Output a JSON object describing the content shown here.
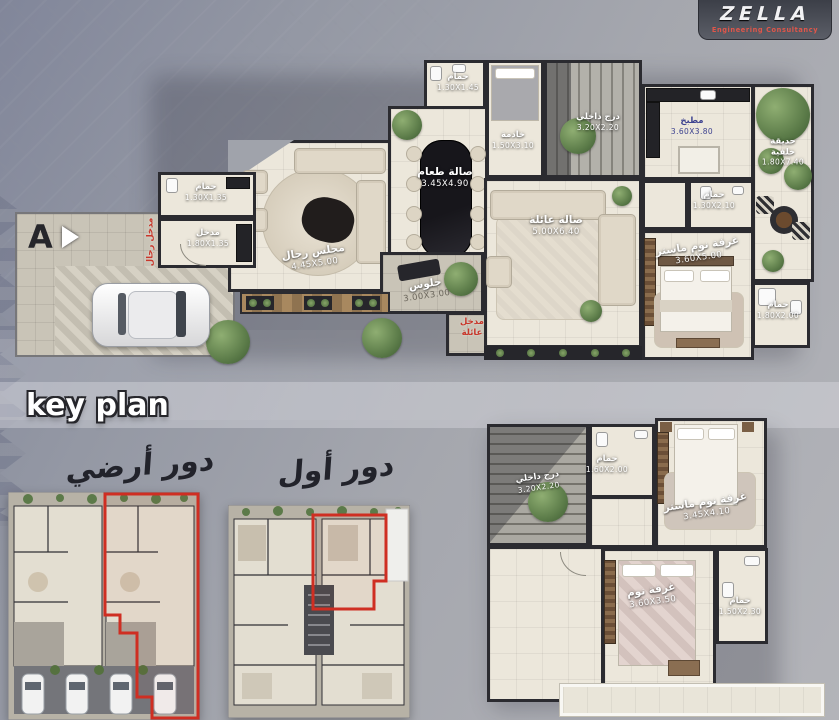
{
  "logo": {
    "brand": "ZELLA",
    "subtitle": "Engineering Consultancy"
  },
  "marker": {
    "label": "A"
  },
  "key_plan": {
    "title": "key plan",
    "ground": "دور أرضي",
    "first": "دور أول"
  },
  "colors": {
    "accent_red": "#c8372b",
    "wall": "#2b2b30",
    "floor": "#ece7db"
  },
  "ground_floor": {
    "entrance_labels": [
      {
        "label": "مدخل رجال"
      },
      {
        "label": "مدخل عائلة"
      }
    ],
    "rooms": [
      {
        "name": "حمام",
        "dim": "1.30X1.45"
      },
      {
        "name": "خادمة",
        "dim": "1.50X3.10"
      },
      {
        "name": "درج داخلي",
        "dim": "3.20X2.20"
      },
      {
        "name": "صالة طعام",
        "dim": "3.45X4.90"
      },
      {
        "name": "مطبخ",
        "dim": "3.60X3.80"
      },
      {
        "name": "حديقة خلفية",
        "dim": "1.80X7.40"
      },
      {
        "name": "حمام",
        "dim": "1.30X2.10"
      },
      {
        "name": "حمام",
        "dim": "1.30X1.35"
      },
      {
        "name": "مدخل",
        "dim": "1.80X1.35"
      },
      {
        "name": "مجلس رجال",
        "dim": "4.45X5.00"
      },
      {
        "name": "جلوس",
        "dim": "3.00X3.00"
      },
      {
        "name": "صالة عائلة",
        "dim": "5.00X6.40"
      },
      {
        "name": "غرفة نوم ماستر",
        "dim": "3.60X5.00"
      },
      {
        "name": "حمام",
        "dim": "1.80X2.00"
      }
    ]
  },
  "first_floor": {
    "rooms": [
      {
        "name": "درج داخلي",
        "dim": "3.20X2.20"
      },
      {
        "name": "حمام",
        "dim": "1.60X2.00"
      },
      {
        "name": "غرفة نوم ماستر",
        "dim": "3.45X4.10"
      },
      {
        "name": "غرفة نوم",
        "dim": "3.60X3.50"
      },
      {
        "name": "حمام",
        "dim": "1.50X2.30"
      }
    ]
  }
}
